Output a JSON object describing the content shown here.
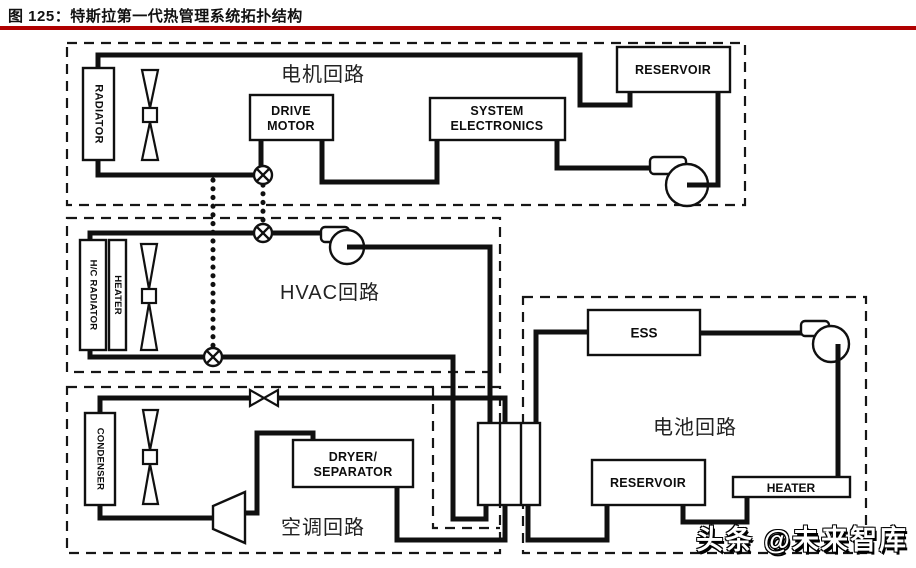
{
  "figure": {
    "title": "图 125：特斯拉第一代热管理系统拓扑结构",
    "accent_color": "#b00000",
    "watermark": "头条 @未来智库"
  },
  "loops": {
    "motor": {
      "label": "电机回路",
      "radiator": "RADIATOR",
      "drive_motor_l1": "DRIVE",
      "drive_motor_l2": "MOTOR",
      "system_electronics_l1": "SYSTEM",
      "system_electronics_l2": "ELECTRONICS",
      "reservoir": "RESERVOIR"
    },
    "hvac": {
      "label": "HVAC回路",
      "hc_radiator": "H/C RADIATOR",
      "heater": "HEATER"
    },
    "ac": {
      "label": "空调回路",
      "condenser": "CONDENSER",
      "dryer_l1": "DRYER/",
      "dryer_l2": "SEPARATOR"
    },
    "battery": {
      "label": "电池回路",
      "ess": "ESS",
      "reservoir": "RESERVOIR",
      "heater": "HEATER"
    }
  },
  "icons": {
    "fan": "axial-fan-icon",
    "pump": "pump-icon",
    "valve": "shutoff-valve-icon",
    "expansion_valve": "expansion-valve-icon",
    "compressor": "compressor-icon",
    "heat_exchanger": "heat-exchanger"
  }
}
